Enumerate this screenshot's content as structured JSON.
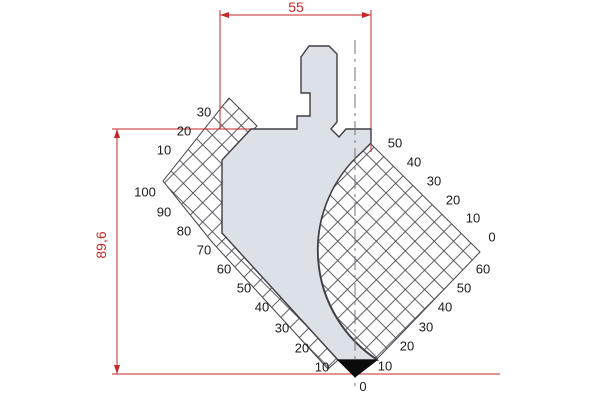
{
  "drawing": {
    "dimensions": {
      "width": "55",
      "height": "89,6"
    },
    "origin_label": "0",
    "rulers": {
      "left_top": [
        "30",
        "20",
        "10"
      ],
      "left_flank": [
        "100",
        "90",
        "80",
        "70",
        "60",
        "50",
        "40",
        "30",
        "20",
        "10"
      ],
      "right_top": [
        "50",
        "40",
        "30",
        "20",
        "10",
        "0"
      ],
      "right_bottom": [
        "60",
        "50",
        "40",
        "30",
        "20",
        "10"
      ]
    },
    "colors": {
      "dimension_red": "#c62828",
      "body_fill": "#dce1e7",
      "outline": "#3e3e44",
      "hatch": "#45454c",
      "tip_black": "#0b0b0c",
      "centerline_gray": "#73737b",
      "label_text": "#1b1b1b",
      "background": "#ffffff"
    }
  }
}
